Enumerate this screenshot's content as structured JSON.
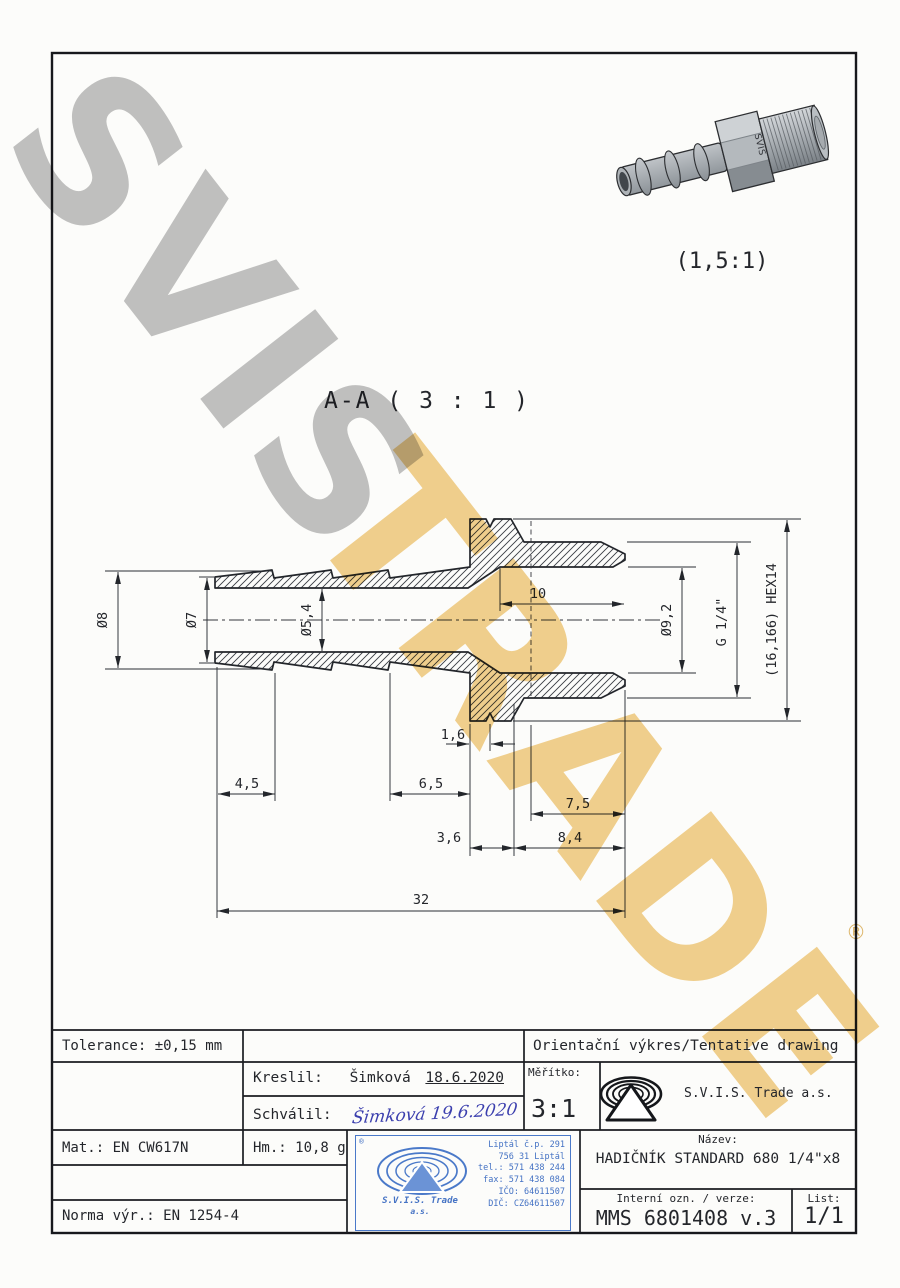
{
  "sheet": {
    "bg": "#fcfcfa",
    "frame_color": "#17181c"
  },
  "watermark": {
    "word1": "SVIS",
    "word2": "TRADE",
    "registered": "®"
  },
  "pictorial": {
    "scale_label": "(1,5:1)",
    "marking": "SVIS"
  },
  "section": {
    "title": "A-A ( 3 : 1 )",
    "dims": {
      "d8": "Ø8",
      "d7": "Ø7",
      "d54": "Ø5,4",
      "d10": "10",
      "d92": "Ø9,2",
      "g14": "G 1/4\"",
      "hex14": "(16,166) HEX14",
      "d16": "1,6",
      "d45": "4,5",
      "d65": "6,5",
      "d75": "7,5",
      "d36": "3,6",
      "d84": "8,4",
      "d32": "32"
    }
  },
  "title_block": {
    "tolerance": "Tolerance: ±0,15 mm",
    "tentative": "Orientační výkres/Tentative drawing",
    "kreslil_label": "Kreslil:",
    "kreslil_name": "Šimková",
    "kreslil_date": "18.6.2020",
    "schvalil_label": "Schválil:",
    "schvalil_signature": "Šimková 19.6.2020",
    "meritko_label": "Měřítko:",
    "meritko_value": "3:1",
    "company": "S.V.I.S. Trade a.s.",
    "mat": "Mat.: EN CW617N",
    "hm": "Hm.: 10,8 g",
    "norma": "Norma výr.: EN 1254-4",
    "nazev_label": "Název:",
    "nazev_value": "HADIČNÍK STANDARD 680 1/4\"x8",
    "interni_label": "Interní ozn. / verze:",
    "interni_value": "MMS 6801408 v.3",
    "list_label": "List:",
    "list_value": "1/1"
  },
  "stamp": {
    "registered": "®",
    "lines": [
      "Liptál č.p. 291",
      "756 31 Liptál",
      "tel.: 571 438 244",
      "fax: 571 438 084",
      "IČO: 64611507",
      "DIČ: CZ64611507"
    ],
    "name1": "S.V.I.S. Trade",
    "name2": "a.s."
  }
}
